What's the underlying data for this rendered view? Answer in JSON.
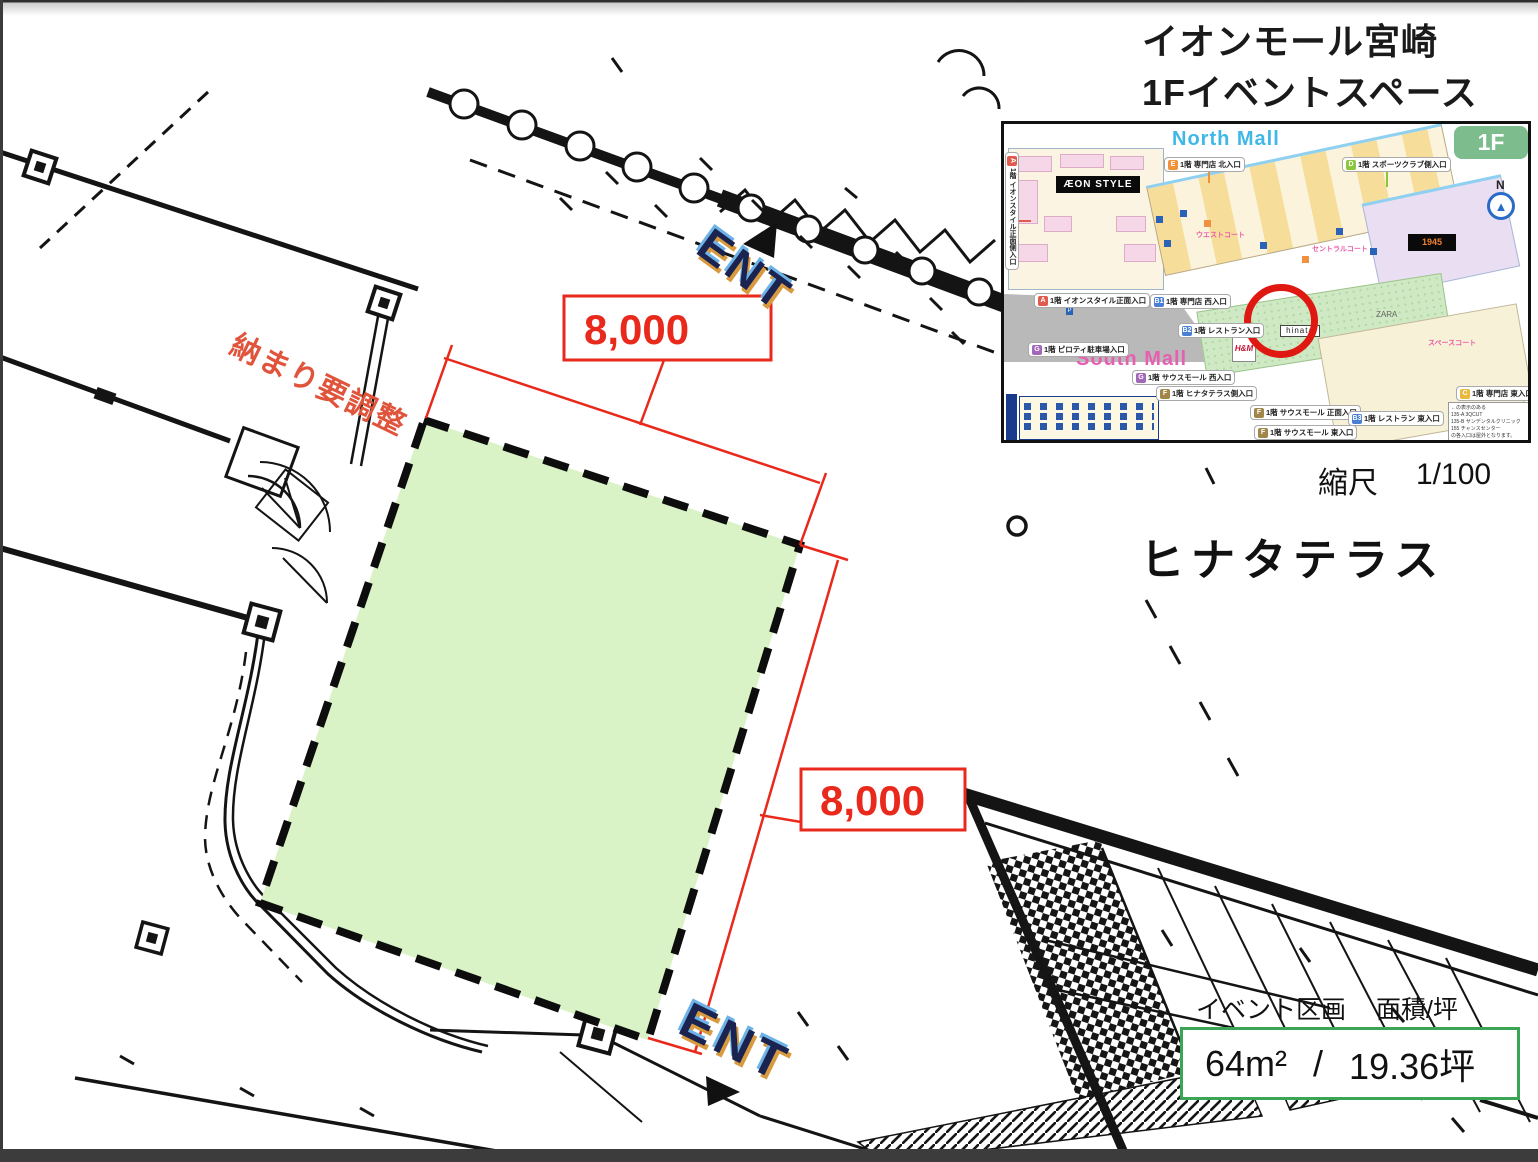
{
  "window": {
    "frame_color": "#3c3c3c"
  },
  "title": {
    "line1": "イオンモール宮崎",
    "line2": "1Fイベントスペース"
  },
  "scale": {
    "label": "縮尺",
    "value": "1/100"
  },
  "space_name": "ヒナタテラス",
  "area_panel": {
    "label_left": "イベント区画",
    "label_right": "面積/坪",
    "sqm": "64m²",
    "separator": "/",
    "tsubo": "19.36坪"
  },
  "plan": {
    "dim_top": "8,000",
    "dim_right": "8,000",
    "ent_top": "ENT",
    "ent_bottom": "ENT",
    "note_red": "納まり要調整",
    "highlight_fill": "#d9f2c6",
    "dim_color": "#e8291c"
  },
  "map": {
    "floor_badge": "1F",
    "north_mall": "North Mall",
    "south_mall": "South Mall",
    "aeon_style": "ÆON STYLE",
    "store_1945": "1945",
    "hinata": "hinata",
    "hm": "H&M",
    "zara": "ZARA",
    "parking": "P",
    "compass": "N",
    "compass_needle": "▲",
    "court_west": "ウエストコート",
    "court_central": "セントラルコート",
    "court_space": "スペースコート",
    "entrances": [
      {
        "letter": "A",
        "label": "1階 イオンスタイル正面側入口",
        "color": "#e05a4e"
      },
      {
        "letter": "E",
        "label": "1階 専門店 北入口",
        "color": "#f0923c"
      },
      {
        "letter": "D",
        "label": "1階 スポーツクラブ側入口",
        "color": "#8cc63e"
      },
      {
        "letter": "A",
        "label": "1階 イオンスタイル正面入口",
        "color": "#e05a4e"
      },
      {
        "letter": "B1",
        "label": "1階 専門店 西入口",
        "color": "#4a7fd4"
      },
      {
        "letter": "B2",
        "label": "1階 レストラン入口",
        "color": "#4a7fd4"
      },
      {
        "letter": "G",
        "label": "1階 ピロティ駐車場入口",
        "color": "#a468b8"
      },
      {
        "letter": "G",
        "label": "1階 サウスモール 西入口",
        "color": "#a468b8"
      },
      {
        "letter": "F",
        "label": "1階 ヒナタテラス側入口",
        "color": "#a08648"
      },
      {
        "letter": "F",
        "label": "1階 サウスモール 正面入口",
        "color": "#a08648"
      },
      {
        "letter": "F",
        "label": "1階 サウスモール 東入口",
        "color": "#a08648"
      },
      {
        "letter": "B3",
        "label": "1階 レストラン 東入口",
        "color": "#4a7fd4"
      },
      {
        "letter": "C",
        "label": "1階 専門店 東入口",
        "color": "#e8b93c"
      }
    ],
    "note_lines": [
      "←の表示のある",
      "135-A 3QCUT",
      "135-B サンデンタルクリニック",
      "155 チャンスセンター",
      "の各入口は屋外となります。"
    ]
  }
}
